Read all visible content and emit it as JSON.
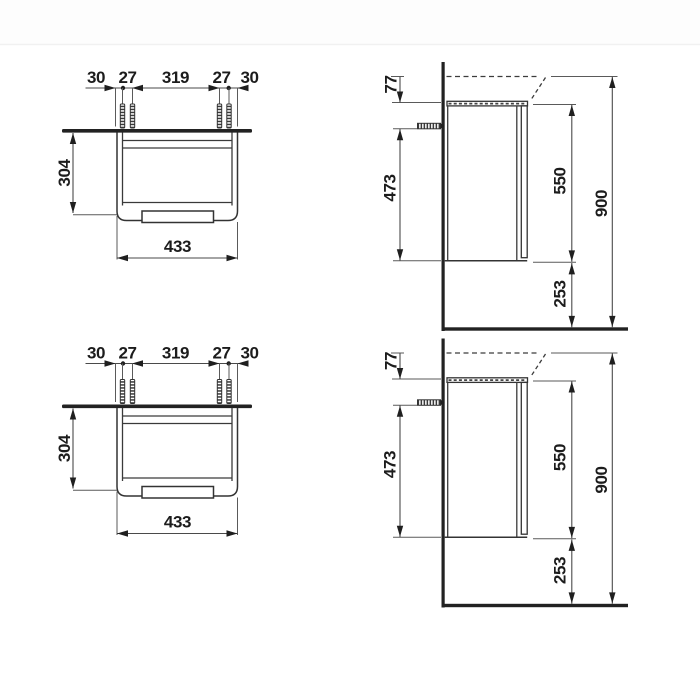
{
  "document": {
    "kind": "technical-dimension-drawing",
    "subject": "wall-mounted washbasin vanity unit, front and side elevations (shown twice)",
    "background": "#ffffff",
    "colors": {
      "outline": "#333333",
      "dimension_line": "#4a4a4a",
      "ink": "#1c1c1c",
      "solid_bars": "#222222"
    }
  },
  "views": [
    {
      "position": "top-left",
      "type": "front-elevation",
      "labels": [
        "30",
        "27",
        "319",
        "27",
        "30",
        "304",
        "433"
      ],
      "label_meaning": [
        "edge to dowel",
        "dowel pair spacing",
        "between dowel pairs",
        "dowel pair spacing",
        "dowel to edge",
        "cabinet height",
        "cabinet width"
      ]
    },
    {
      "position": "top-right",
      "type": "side-elevation",
      "labels": [
        "77",
        "473",
        "550",
        "900",
        "253"
      ],
      "label_meaning": [
        "basin top to cabinet top",
        "fixing screw to cabinet bottom",
        "cabinet front height",
        "overall height above floor",
        "clearance below cabinet"
      ]
    },
    {
      "position": "bottom-left",
      "type": "front-elevation",
      "labels": [
        "30",
        "27",
        "319",
        "27",
        "30",
        "304",
        "433"
      ]
    },
    {
      "position": "bottom-right",
      "type": "side-elevation",
      "labels": [
        "77",
        "473",
        "550",
        "900",
        "253"
      ]
    }
  ]
}
